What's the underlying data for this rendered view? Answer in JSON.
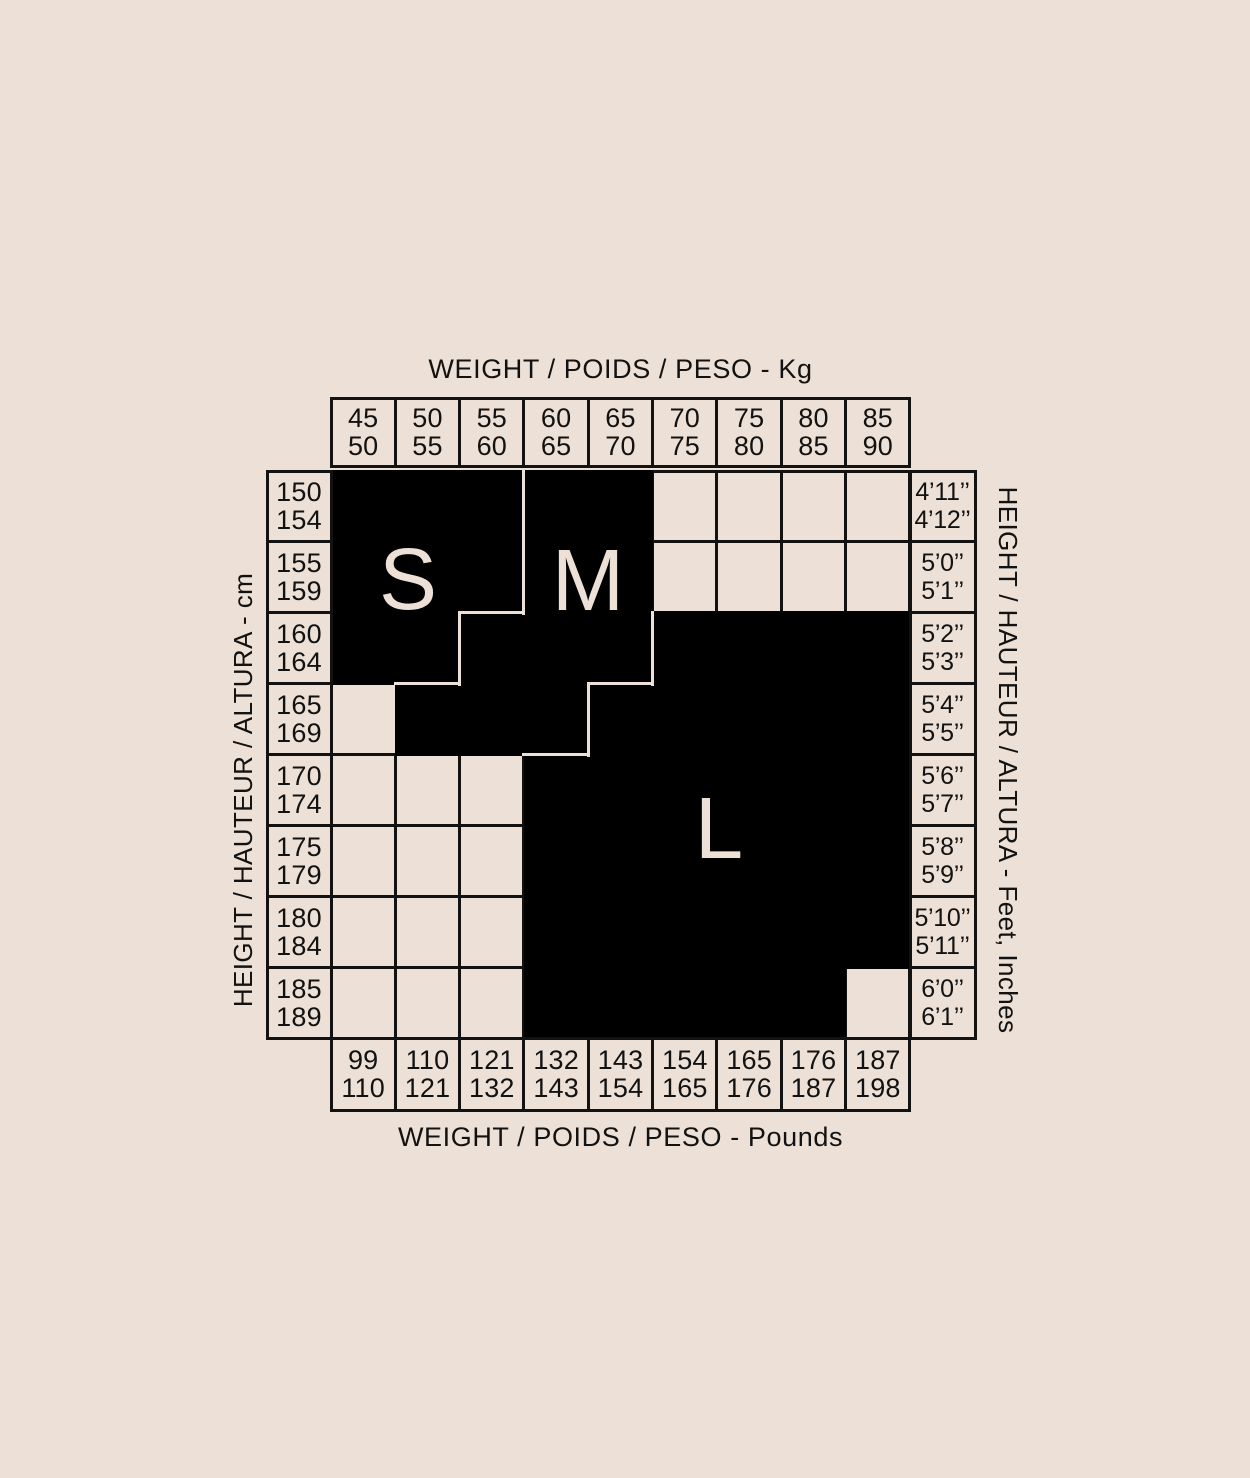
{
  "colors": {
    "background": "#EDE0D6",
    "ink": "#121212",
    "region_fill": "#000000",
    "region_letter": "#EDE0D6"
  },
  "chart_data": {
    "type": "heatmap",
    "title_top": "WEIGHT / POIDS / PESO - Kg",
    "title_bottom": "WEIGHT / POIDS / PESO - Pounds",
    "axis_left": "HEIGHT / HAUTEUR / ALTURA - cm",
    "axis_right": "HEIGHT / HAUTEUR / ALTURA - Feet, Inches",
    "weight_kg_columns": [
      [
        "45",
        "50"
      ],
      [
        "50",
        "55"
      ],
      [
        "55",
        "60"
      ],
      [
        "60",
        "65"
      ],
      [
        "65",
        "70"
      ],
      [
        "70",
        "75"
      ],
      [
        "75",
        "80"
      ],
      [
        "80",
        "85"
      ],
      [
        "85",
        "90"
      ]
    ],
    "weight_lb_columns": [
      [
        "99",
        "110"
      ],
      [
        "110",
        "121"
      ],
      [
        "121",
        "132"
      ],
      [
        "132",
        "143"
      ],
      [
        "143",
        "154"
      ],
      [
        "154",
        "165"
      ],
      [
        "165",
        "176"
      ],
      [
        "176",
        "187"
      ],
      [
        "187",
        "198"
      ]
    ],
    "height_cm_rows": [
      [
        "150",
        "154"
      ],
      [
        "155",
        "159"
      ],
      [
        "160",
        "164"
      ],
      [
        "165",
        "169"
      ],
      [
        "170",
        "174"
      ],
      [
        "175",
        "179"
      ],
      [
        "180",
        "184"
      ],
      [
        "185",
        "189"
      ]
    ],
    "height_ft_rows": [
      [
        "4’11’’",
        "4’12’’"
      ],
      [
        "5’0’’",
        "5’1’’"
      ],
      [
        "5’2’’",
        "5’3’’"
      ],
      [
        "5’4’’",
        "5’5’’"
      ],
      [
        "5’6’’",
        "5’7’’"
      ],
      [
        "5’8’’",
        "5’9’’"
      ],
      [
        "5’10’’",
        "5’11’’"
      ],
      [
        "6’0’’",
        "6’1’’"
      ]
    ],
    "size_letters": {
      "S": "S",
      "M": "M",
      "L": "L"
    },
    "cell_size_map": [
      [
        "S",
        "S",
        "S",
        "M",
        "M",
        ".",
        ".",
        ".",
        "."
      ],
      [
        "S",
        "S",
        "S",
        "M",
        "M",
        ".",
        ".",
        ".",
        "."
      ],
      [
        "S",
        "S",
        "M",
        "M",
        "M",
        "L",
        "L",
        "L",
        "L"
      ],
      [
        "",
        "M",
        "M",
        "M",
        "L",
        "L",
        "L",
        "L",
        "L"
      ],
      [
        ".",
        ".",
        ".",
        "L",
        "L",
        "L",
        "L",
        "L",
        "L"
      ],
      [
        ".",
        ".",
        ".",
        "L",
        "L",
        "L",
        "L",
        "L",
        "L"
      ],
      [
        ".",
        ".",
        ".",
        "L",
        "L",
        "L",
        "L",
        "L",
        "L"
      ],
      [
        ".",
        ".",
        ".",
        "L",
        "L",
        "L",
        "L",
        "L",
        "."
      ]
    ]
  }
}
